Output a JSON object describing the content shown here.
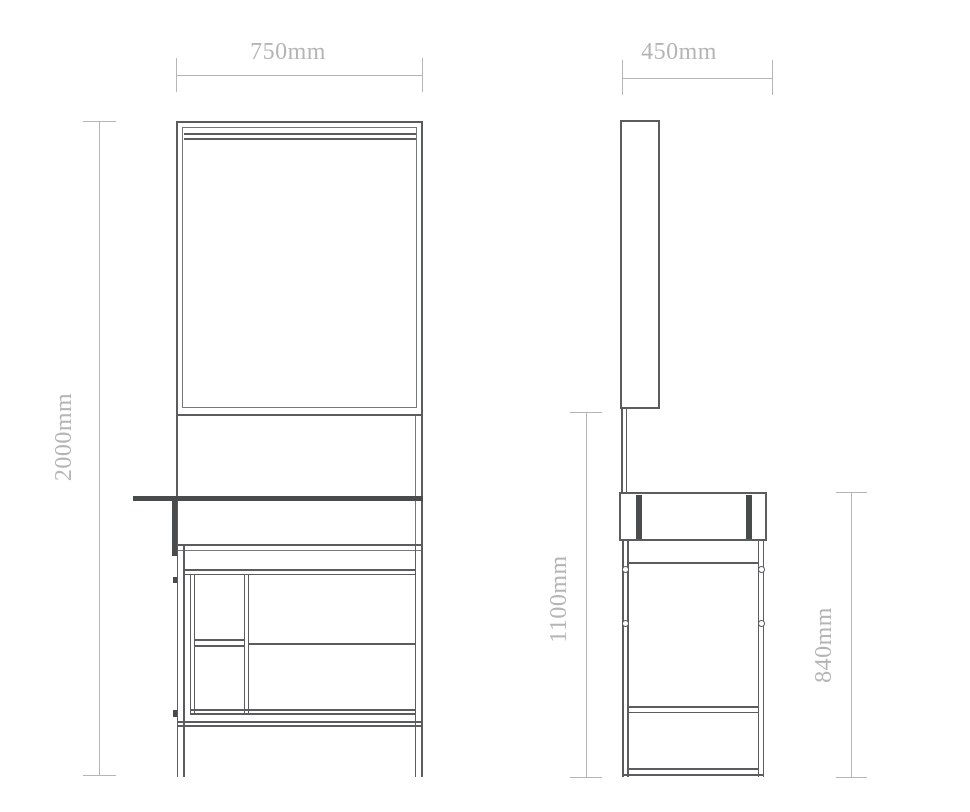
{
  "dimensions": {
    "front_width": "750mm",
    "side_depth": "450mm",
    "overall_height": "2000mm",
    "mirror_bottom_height": "1100mm",
    "table_section_height": "840mm"
  },
  "colors": {
    "ink": "#5b5c5e",
    "ink_mid": "#77787a",
    "ink_strong": "#4a4b4d",
    "dim": "#b5b5b6",
    "background": "#ffffff"
  }
}
